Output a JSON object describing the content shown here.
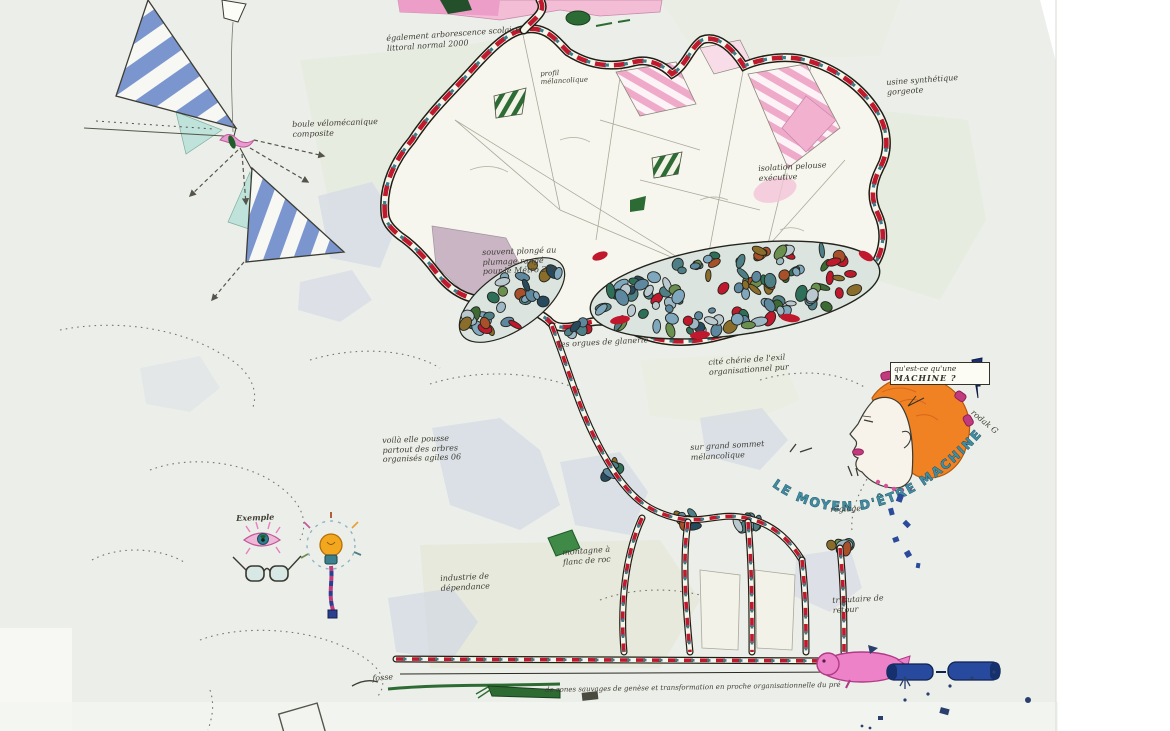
{
  "artwork": {
    "kind": "hand-drawn imaginary map artwork",
    "face": {
      "bubble_line1": "qu'est-ce qu'une",
      "bubble_line2": "MACHINE ?",
      "arc_caption": "LE MOYEN D'ÊTRE MACHINE ?"
    },
    "annotations": [
      "boule vélomécanique\ncomposite",
      "également arborescence scolaire\nlittoral normal 2000",
      "profil\nmélancolique",
      "souvent plongé au\nplumage rangé\npour le Métro 202",
      "les orgues de glanerie",
      "cité chérie de l'exil\norganisationnel pur",
      "isolation pelouse\nexécutive",
      "usine synthétique\ngorgeote",
      "voilà elle pousse\npartout des arbres\norganisés agiles 06",
      "sur grand sommet\nmélancolique",
      "Exemple",
      "industrie de\ndépendance",
      "montagne à\nflanc de roc",
      "tributaire de\nretour",
      "réglage",
      "rodak G",
      "fosse",
      "de zones sauvages de genèse et transformation en proche organisationnelle du pré"
    ]
  },
  "palette": {
    "paper": "#ecefe9",
    "accent_red": "#c0182c",
    "teal": "#3d7a8a",
    "navy": "#274a9e",
    "pink": "#ee82c8",
    "orange_hair": "#f08223",
    "stripe_blue": "#7b96cf",
    "leaf_green": "#2d6b35",
    "mauve": "#c5afc0",
    "pebble_colors": [
      "#7fa7bd",
      "#5e87a0",
      "#9fb8c6",
      "#4f7f86",
      "#6b8f4e",
      "#3d6b33",
      "#8a6d2a",
      "#a8502a",
      "#274a5e",
      "#b9c9cf",
      "#2e6f5a",
      "#7fa7bd",
      "#5e87a0",
      "#4f7f86",
      "#c0182c"
    ]
  }
}
